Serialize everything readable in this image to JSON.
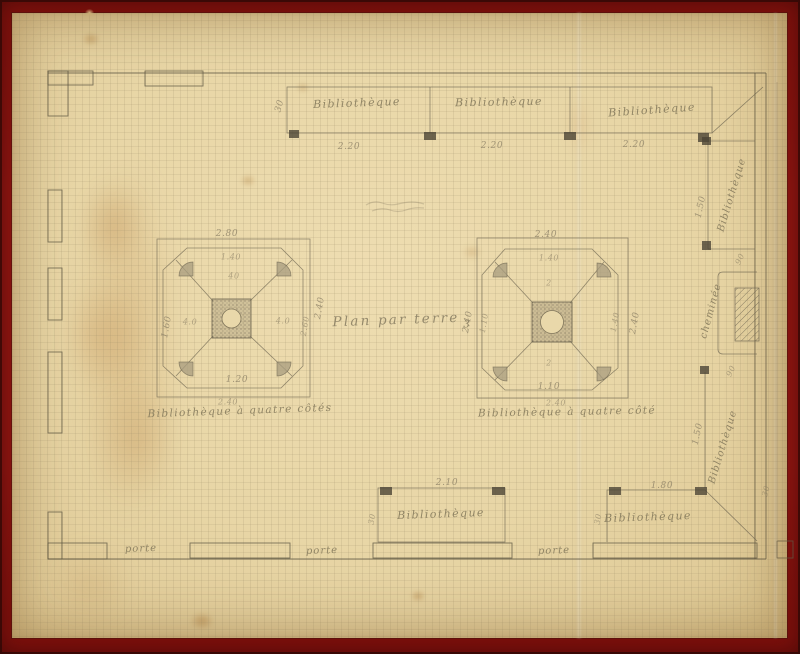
{
  "plan": {
    "title": "Plan par terre",
    "title_note": "3",
    "doors": [
      "porte",
      "porte",
      "porte"
    ],
    "shelves": {
      "top_row": {
        "sections": [
          {
            "label": "Bibliothèque",
            "width": "2.20"
          },
          {
            "label": "Bibliothèque",
            "width": "2.20"
          },
          {
            "label": "Bibliothèque",
            "width": "2.20"
          }
        ],
        "depth": "30"
      },
      "right_upper": {
        "label": "Bibliothèque",
        "length": "1.50",
        "end": "90"
      },
      "right_lower": {
        "label": "Bibliothèque",
        "length": "1.50",
        "end": "30"
      },
      "bottom_middle": {
        "label": "Bibliothèque",
        "width": "2.10",
        "depth": "30"
      },
      "bottom_right": {
        "label": "Bibliothèque",
        "width": "1.80",
        "depth": "30"
      }
    },
    "chimney": {
      "label": "cheminée",
      "dim_below": "90"
    },
    "tables": {
      "left": {
        "caption": "Bibliothèque à quatre côtés",
        "caption_dim": "2.40",
        "dim_top": "2.80",
        "dim_inner_top": "1.40",
        "dim_left": "1.60",
        "dim_right": "2.40",
        "dim_right_inner": "2.60",
        "dim_bottom": "1.20",
        "dim_arm_top": "40",
        "dim_arm_left": "4.0",
        "dim_arm_right": "4.0"
      },
      "right": {
        "caption": "Bibliothèque à quatre côté",
        "caption_dim": "2.40",
        "dim_top": "2.40",
        "dim_inner_top": "1.40",
        "dim_left": "2.40",
        "dim_left_inner": "1.10",
        "dim_right": "2.40",
        "dim_right_inner": "1.40",
        "dim_bottom_inner": "1.10",
        "mark_top": "2",
        "mark_bottom": "2"
      }
    }
  }
}
